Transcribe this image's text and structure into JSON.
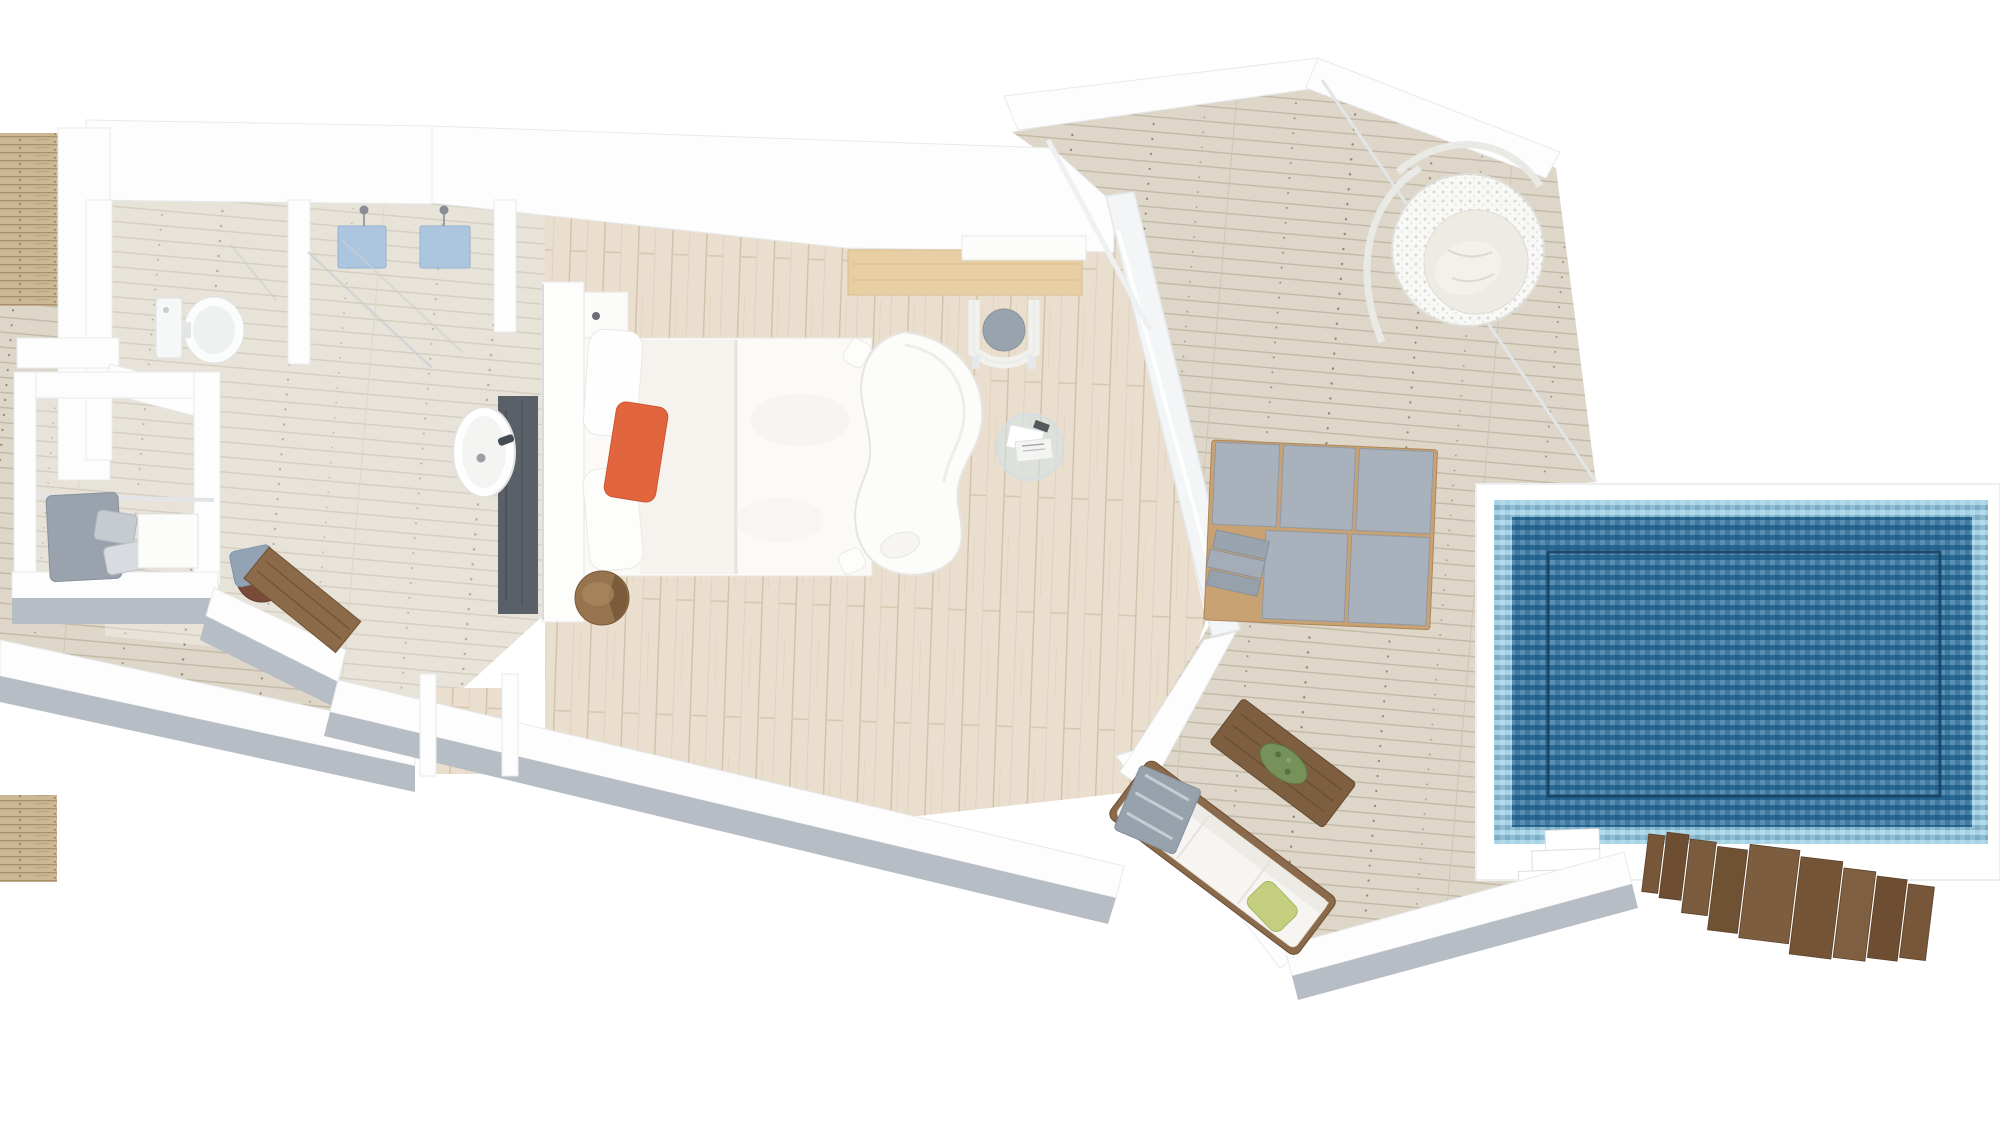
{
  "scene": {
    "type": "floor-plan-3d-render",
    "background_color": "#ffffff"
  },
  "colors": {
    "background": "#ffffff",
    "interior_floor_wood": "#eadfce",
    "deck_wood": "#ded7c9",
    "wall_white": "#fdfdfd",
    "wall_face_gray": "#b7bdc5",
    "side_wall_wood": "#ccb795",
    "pool_tile_border": "#9ccfe6",
    "pool_basin": "#2d6f9c",
    "pool_shelf_line": "#173f61",
    "accent_pillow_orange": "#e2663d",
    "shower_tray_blue": "#adc6e0",
    "cushion_gray": "#a9b2bc",
    "sofa_frame_wood": "#8a6a4a",
    "stairs_wood": "#7b5b3d",
    "stool_wood": "#7a4a3a",
    "counter_dark": "#5a6068",
    "plant_green": "#76925a",
    "throw_green": "#c3cf7e"
  },
  "rooms": [
    {
      "id": "bathroom",
      "label": "Bathroom with WC, twin showers and round basin vanity"
    },
    {
      "id": "closet",
      "label": "Closet / dressing room with bench and side table"
    },
    {
      "id": "bedroom",
      "label": "Bedroom with king bed, desk, glass table and chaise longue"
    },
    {
      "id": "deck",
      "label": "Outdoor timber sun deck"
    },
    {
      "id": "pool",
      "label": "Private rectangular mosaic-tiled swimming pool"
    }
  ],
  "furniture": [
    {
      "id": "toilet",
      "label": "Toilet",
      "room": "bathroom"
    },
    {
      "id": "shower-trays",
      "label": "Twin showers with blue trays and rain heads",
      "room": "bathroom"
    },
    {
      "id": "round-sink",
      "label": "Round basin on dark vanity counter",
      "room": "bathroom"
    },
    {
      "id": "closet-bench",
      "label": "Bench with grey cushions and pillows",
      "room": "closet"
    },
    {
      "id": "closet-table",
      "label": "White side table",
      "room": "closet"
    },
    {
      "id": "stool-bench",
      "label": "Round stool with towel and wooden board bench",
      "room": "bathroom"
    },
    {
      "id": "king-bed",
      "label": "King bed, white duvet, orange accent pillow",
      "room": "bedroom"
    },
    {
      "id": "nightstand",
      "label": "Wall-hung nightstand",
      "room": "bedroom"
    },
    {
      "id": "log-stool",
      "label": "Log side stool at bed foot",
      "room": "bedroom"
    },
    {
      "id": "desk",
      "label": "Timber desk with white wall shelf",
      "room": "bedroom"
    },
    {
      "id": "desk-chair",
      "label": "Desk chair with grey cushion",
      "room": "bedroom"
    },
    {
      "id": "glass-table",
      "label": "Round glass side table with magazines",
      "room": "bedroom"
    },
    {
      "id": "chaise",
      "label": "White curved chaise longue",
      "room": "bedroom"
    },
    {
      "id": "hanging-chair",
      "label": "Hanging rattan egg chair",
      "room": "deck"
    },
    {
      "id": "daybed",
      "label": "Double sun daybed with grey cushions",
      "room": "deck"
    },
    {
      "id": "outdoor-sofa",
      "label": "Outdoor sofa with striped throw and green pillow",
      "room": "deck"
    },
    {
      "id": "coffee-table",
      "label": "Timber coffee table with plant tray",
      "room": "deck"
    },
    {
      "id": "pool-steps",
      "label": "White pool entry steps",
      "room": "pool"
    },
    {
      "id": "timber-stairs",
      "label": "Timber stairs leading off the deck",
      "room": "deck"
    }
  ]
}
